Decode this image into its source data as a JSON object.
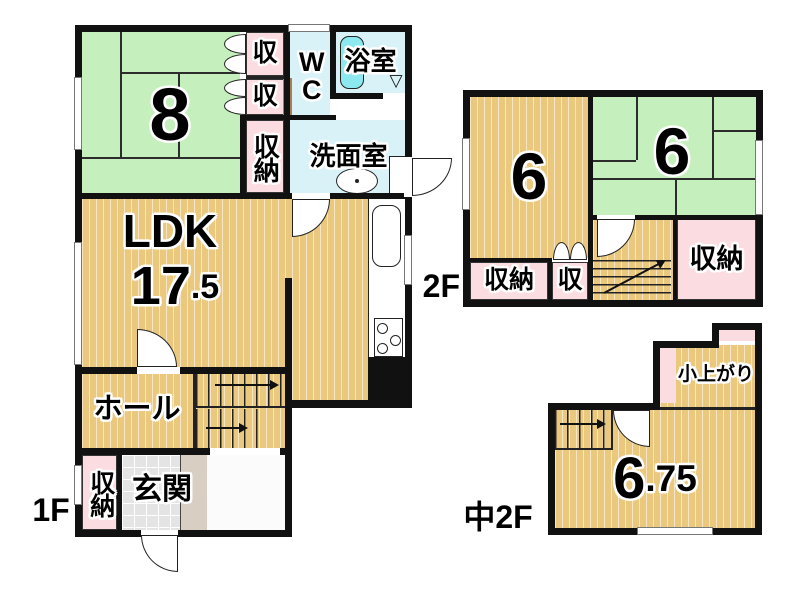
{
  "document": {
    "type": "japanese-floor-plan",
    "background": "#ffffff"
  },
  "colors": {
    "wall": "#111111",
    "tatami_green": "#c6efbe",
    "wood_tan": "#eac87e",
    "closet_pink": "#fbdce1",
    "water_blue": "#d9f2f8",
    "bathtub_cyan": "#8ce9ef",
    "entry_tile_gray": "#e4e4e4",
    "step_beige": "#d9cec2",
    "door_pocket_brown": "#a57e55"
  },
  "floor1": {
    "label": "1F",
    "tatami_room": "8",
    "closet_upper": "収",
    "closet_lower": "収",
    "wc": "WC",
    "bath": "浴室",
    "closet_tall": "収納",
    "washroom": "洗面室",
    "ldk": "LDK",
    "ldk_area_int": "17",
    "ldk_area_dec": ".5",
    "hall": "ホール",
    "entry_closet": "収納",
    "entrance": "玄関"
  },
  "floor2": {
    "label": "2F",
    "room_west": "6",
    "room_east": "6",
    "closet_sw": "収納",
    "closet_s": "収",
    "closet_se": "収納"
  },
  "mezzanine": {
    "label": "中2F",
    "koagari": "小上がり",
    "area_int": "6",
    "area_dec": ".75"
  },
  "icons": {
    "bath_door": "▽"
  }
}
